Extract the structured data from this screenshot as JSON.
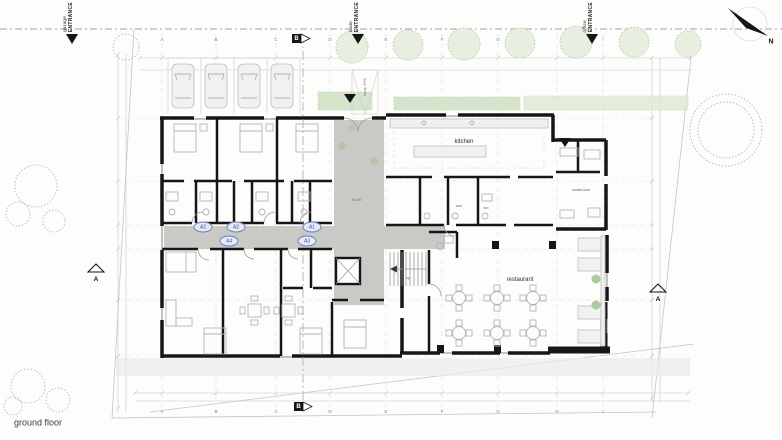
{
  "title": "ground floor",
  "compass": "N",
  "entrances": [
    {
      "word": "garage",
      "label": "ENTRANCE"
    },
    {
      "word": "main",
      "label": "ENTRANCE"
    },
    {
      "word": "office",
      "label": "ENTRANCE"
    }
  ],
  "labels": {
    "kitchen": "kitchen",
    "restaurant": "restaurant",
    "cloakroom": "cloakroom",
    "wm": "wm",
    "wc": "wc",
    "up": "up",
    "ramp": "ramp 15%",
    "level": "±0.00"
  },
  "unit_badges": {
    "u1": "A2",
    "u2": "A2",
    "u3": "A1",
    "u4": "A4",
    "u5": "A3"
  },
  "grid": [
    "A",
    "B",
    "C",
    "D",
    "E",
    "F",
    "G",
    "H",
    "I"
  ],
  "sections": {
    "a": "A",
    "b": "B"
  },
  "colors": {
    "wall": "#161616",
    "corridor": "#c9c9c6",
    "pavement": "#eaeae8",
    "hedge": "#cfe0c2",
    "badge-stroke": "#6d80b8",
    "badge-fill": "#e3e9f7",
    "boundary": "#9aa1b8"
  }
}
